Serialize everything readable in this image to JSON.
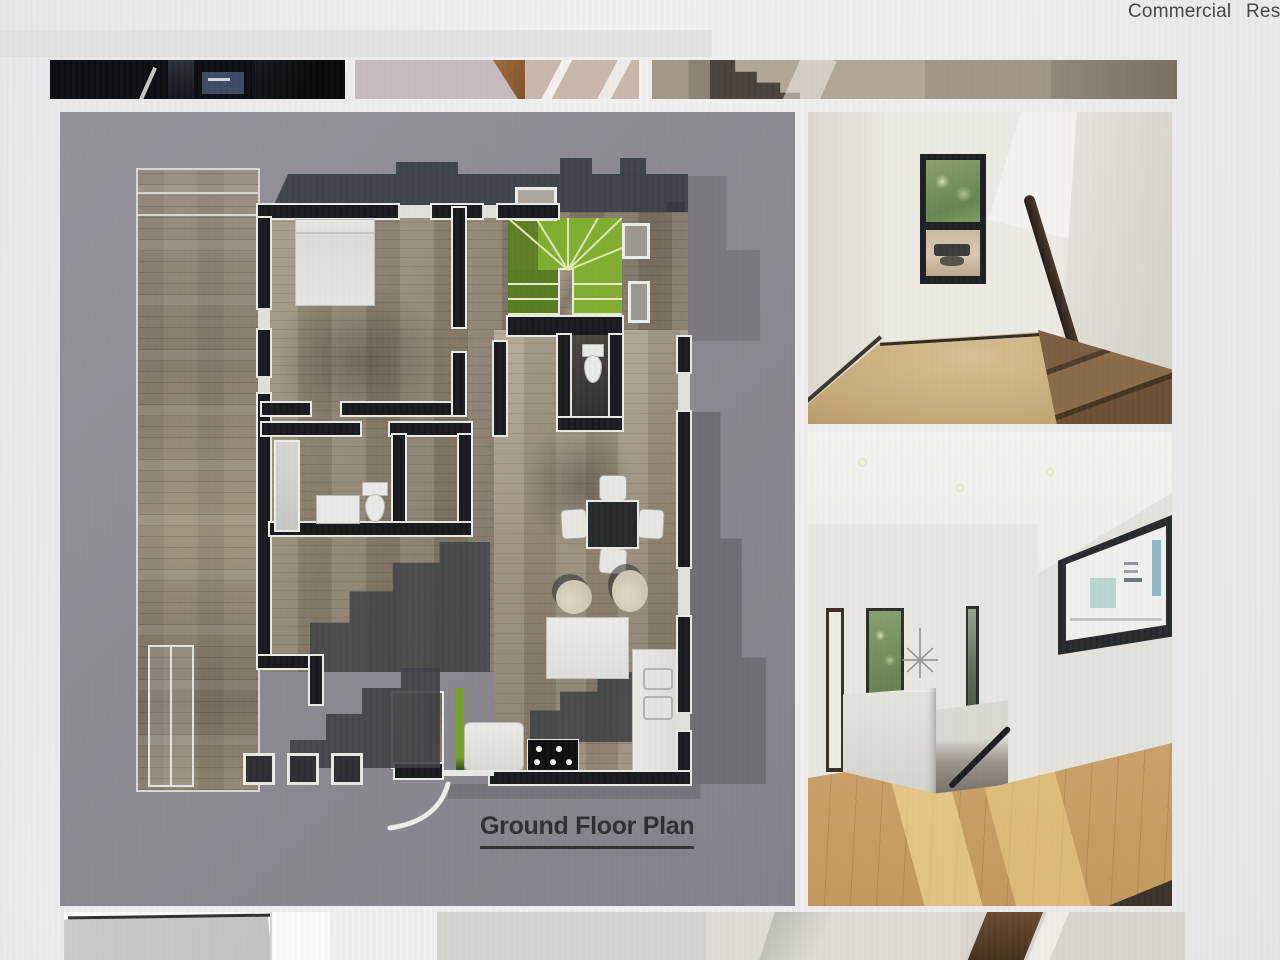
{
  "nav": {
    "items": [
      {
        "label": "Commercial"
      },
      {
        "label": "Res"
      }
    ]
  },
  "gallery": {
    "top_thumbnails": [
      {
        "name": "dark-media-room-thumbnail"
      },
      {
        "name": "stair-corner-carpet-thumbnail"
      },
      {
        "name": "staircase-hall-thumbnail"
      }
    ],
    "floor_plan": {
      "caption": "Ground Floor Plan",
      "rooms": [
        "bedroom",
        "bathroom",
        "powder-room",
        "living-room",
        "dining-area",
        "kitchen",
        "winder-staircase",
        "entry-porch"
      ]
    },
    "photos": [
      {
        "name": "stairwell-with-window-photo"
      },
      {
        "name": "upper-hallway-stair-landing-photo"
      }
    ],
    "bottom_thumbnails": [
      {
        "name": "white-interior-corner-thumbnail"
      },
      {
        "name": "stair-stringer-detail-thumbnail"
      }
    ]
  },
  "colors": {
    "accent_green": "#7fae2e",
    "dark_green": "#587c20",
    "roof_charcoal": "#3f434a",
    "plan_backdrop": "#8b8890",
    "plank_wood": "#9a8c7c",
    "oak_floor": "#c79e62",
    "handrail_walnut": "#32251d",
    "text_dark": "#2e2e31"
  }
}
